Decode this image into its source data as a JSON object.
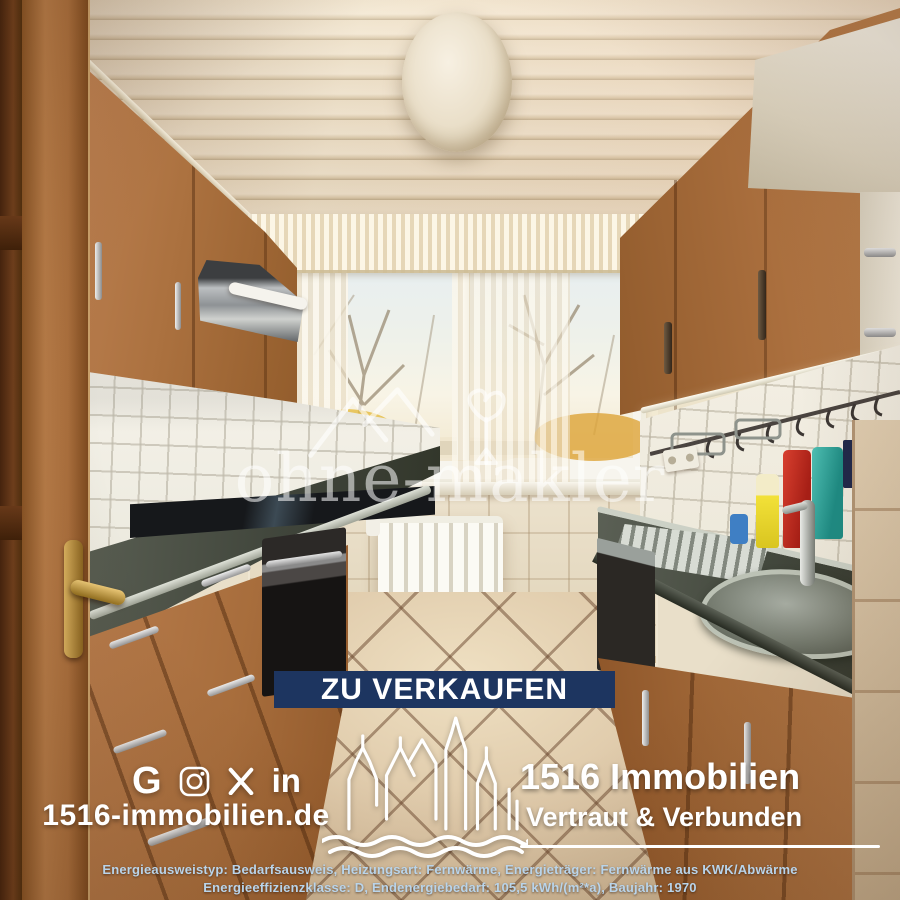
{
  "watermark": {
    "brand": "ohne-makler"
  },
  "banner": {
    "label": "ZU VERKAUFEN"
  },
  "footer": {
    "website": "1516-immobilien.de",
    "company": "1516 Immobilien",
    "tagline": "Vertraut & Verbunden",
    "social_icons": [
      {
        "name": "google",
        "glyph": "G"
      },
      {
        "name": "instagram",
        "glyph": ""
      },
      {
        "name": "x-twitter",
        "glyph": ""
      },
      {
        "name": "linkedin",
        "glyph": "in"
      }
    ]
  },
  "energy_info": {
    "line1": "Energieausweistyp: Bedarfsausweis, Heizungsart: Fernwärme, Energieträger: Fernwärme aus KWK/Abwärme",
    "line2": "Energieeffizienzklasse: D, Endenergiebedarf: 105,5 kWh/(m²*a), Baujahr: 1970"
  },
  "colors": {
    "banner_bg": "#1d3560",
    "overlay_text": "#ffffff",
    "energy_text": "#b9d4ea"
  }
}
